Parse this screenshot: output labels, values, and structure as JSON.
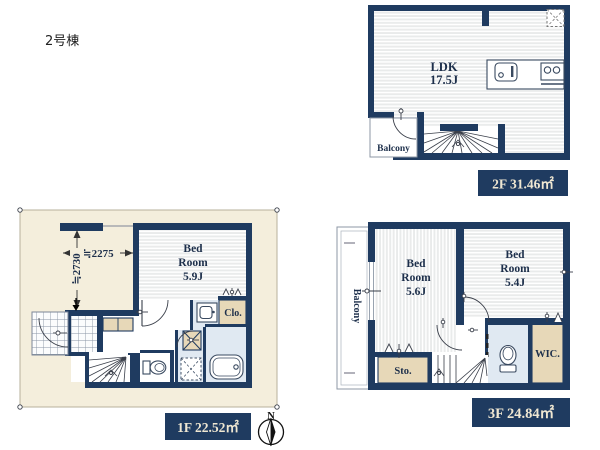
{
  "page": {
    "building_label": "2号棟"
  },
  "colors": {
    "wall_navy": "#1f3b60",
    "lot_cream": "#f4eedc",
    "room_beige": "#e7d8b8",
    "wet_room_blue": "#e0e9f2",
    "area_badge_bg": "#1f3b60",
    "area_badge_text": "#efe7d2",
    "room_text": "#1d2f4b"
  },
  "floor_2f": {
    "ldk_label": "LDK",
    "ldk_size": "17.5J",
    "balcony_label": "Balcony",
    "area_badge": "2F 31.46㎡"
  },
  "floor_1f": {
    "bedroom_label_1": "Bed",
    "bedroom_label_2": "Room",
    "bedroom_size": "5.9J",
    "closet_label": "Clo.",
    "dim_width": "≒2275",
    "dim_height": "≒2730",
    "area_badge": "1F 22.52㎡",
    "compass_north": "N"
  },
  "floor_3f": {
    "balcony_label": "Balcony",
    "bedroom1_label_1": "Bed",
    "bedroom1_label_2": "Room",
    "bedroom1_size": "5.6J",
    "bedroom2_label_1": "Bed",
    "bedroom2_label_2": "Room",
    "bedroom2_size": "5.4J",
    "storage_label": "Sto.",
    "wic_label": "WIC.",
    "area_badge": "3F 24.84㎡"
  },
  "icons": [
    "kitchen-sink-icon",
    "stove-icon",
    "skylight-icon",
    "toilet-icon",
    "bathtub-icon",
    "vanity-icon",
    "washing-machine-pan-icon",
    "stairs-icon",
    "door-arc-icon",
    "compass-icon",
    "entrance-arrow-icon"
  ]
}
